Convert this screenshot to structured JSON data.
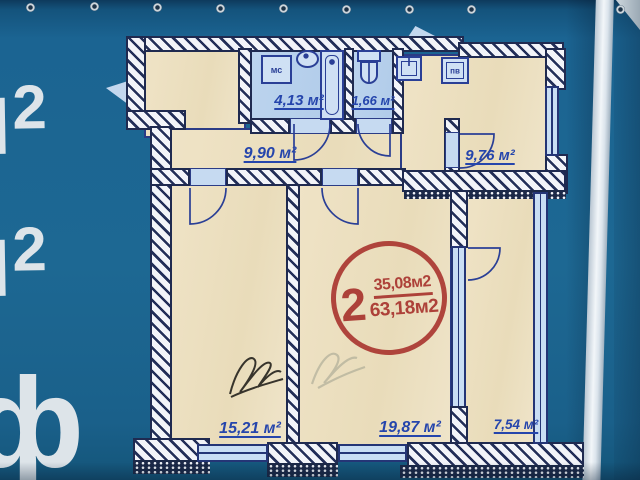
{
  "banner": {
    "background_color": "#1d6893",
    "fold_color": "#f2f6f9",
    "watermarks": {
      "m2_top": "м",
      "m2_top_sup": "2",
      "m2_mid": "м",
      "m2_mid_sup": "2",
      "f_bottom": "ф"
    }
  },
  "floorplan": {
    "stamp": {
      "rooms_count": "2",
      "area_top": "35,08м2",
      "area_bottom": "63,18м2",
      "color": "#aa3832"
    },
    "rooms": [
      {
        "id": "hall",
        "area_label": "9,90 м²"
      },
      {
        "id": "bathroom",
        "area_label": "4,13 м²"
      },
      {
        "id": "wc",
        "area_label": "1,66 м²"
      },
      {
        "id": "kitchen",
        "area_label": "9,76 м²"
      },
      {
        "id": "bedroom",
        "area_label": "15,21 м²"
      },
      {
        "id": "living",
        "area_label": "19,87 м²"
      },
      {
        "id": "balcony",
        "area_label": "7,54 м²"
      }
    ],
    "fixtures": {
      "washer_label": "мс",
      "vent_label": "пв"
    },
    "colors": {
      "walls": "#1f2a50",
      "rooms_fill": "#ecdfc1",
      "wet_fill": "#b7d0eb",
      "lines": "#2a3f96",
      "labels": "#2545ac"
    }
  }
}
